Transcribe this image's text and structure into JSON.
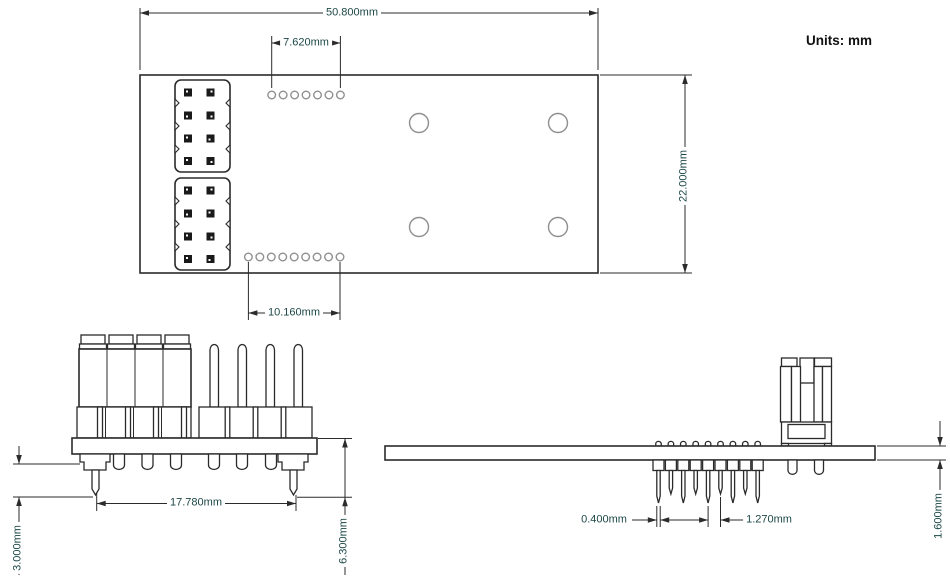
{
  "page": {
    "units_label": "Units: mm",
    "background": "#ffffff"
  },
  "colors": {
    "drawing_line": "#2b2b2b",
    "hole_outline": "#8f8f8f",
    "dimension_text": "#1d4747",
    "units_text": "#111111",
    "pad_fill": "#1a1a1a"
  },
  "views": {
    "top_view": {
      "dimensions": {
        "board_width": "50.800mm",
        "top_hole_pitch_span": "7.620mm",
        "board_height": "22.000mm",
        "bottom_hole_pitch_span": "10.160mm"
      },
      "features": {
        "top_hole_count": 7,
        "bottom_hole_count": 9,
        "mounting_hole_count": 4,
        "header_blocks": 2,
        "pads_per_block": 8
      }
    },
    "front_view": {
      "dimensions": {
        "pin_row_span": "17.780mm",
        "pin_tail_length": "3.000mm",
        "overall_below_height": "6.300mm"
      }
    },
    "side_view": {
      "dimensions": {
        "pin_thickness": "0.400mm",
        "pin_pitch": "1.270mm",
        "board_thickness": "1.600mm"
      }
    }
  }
}
